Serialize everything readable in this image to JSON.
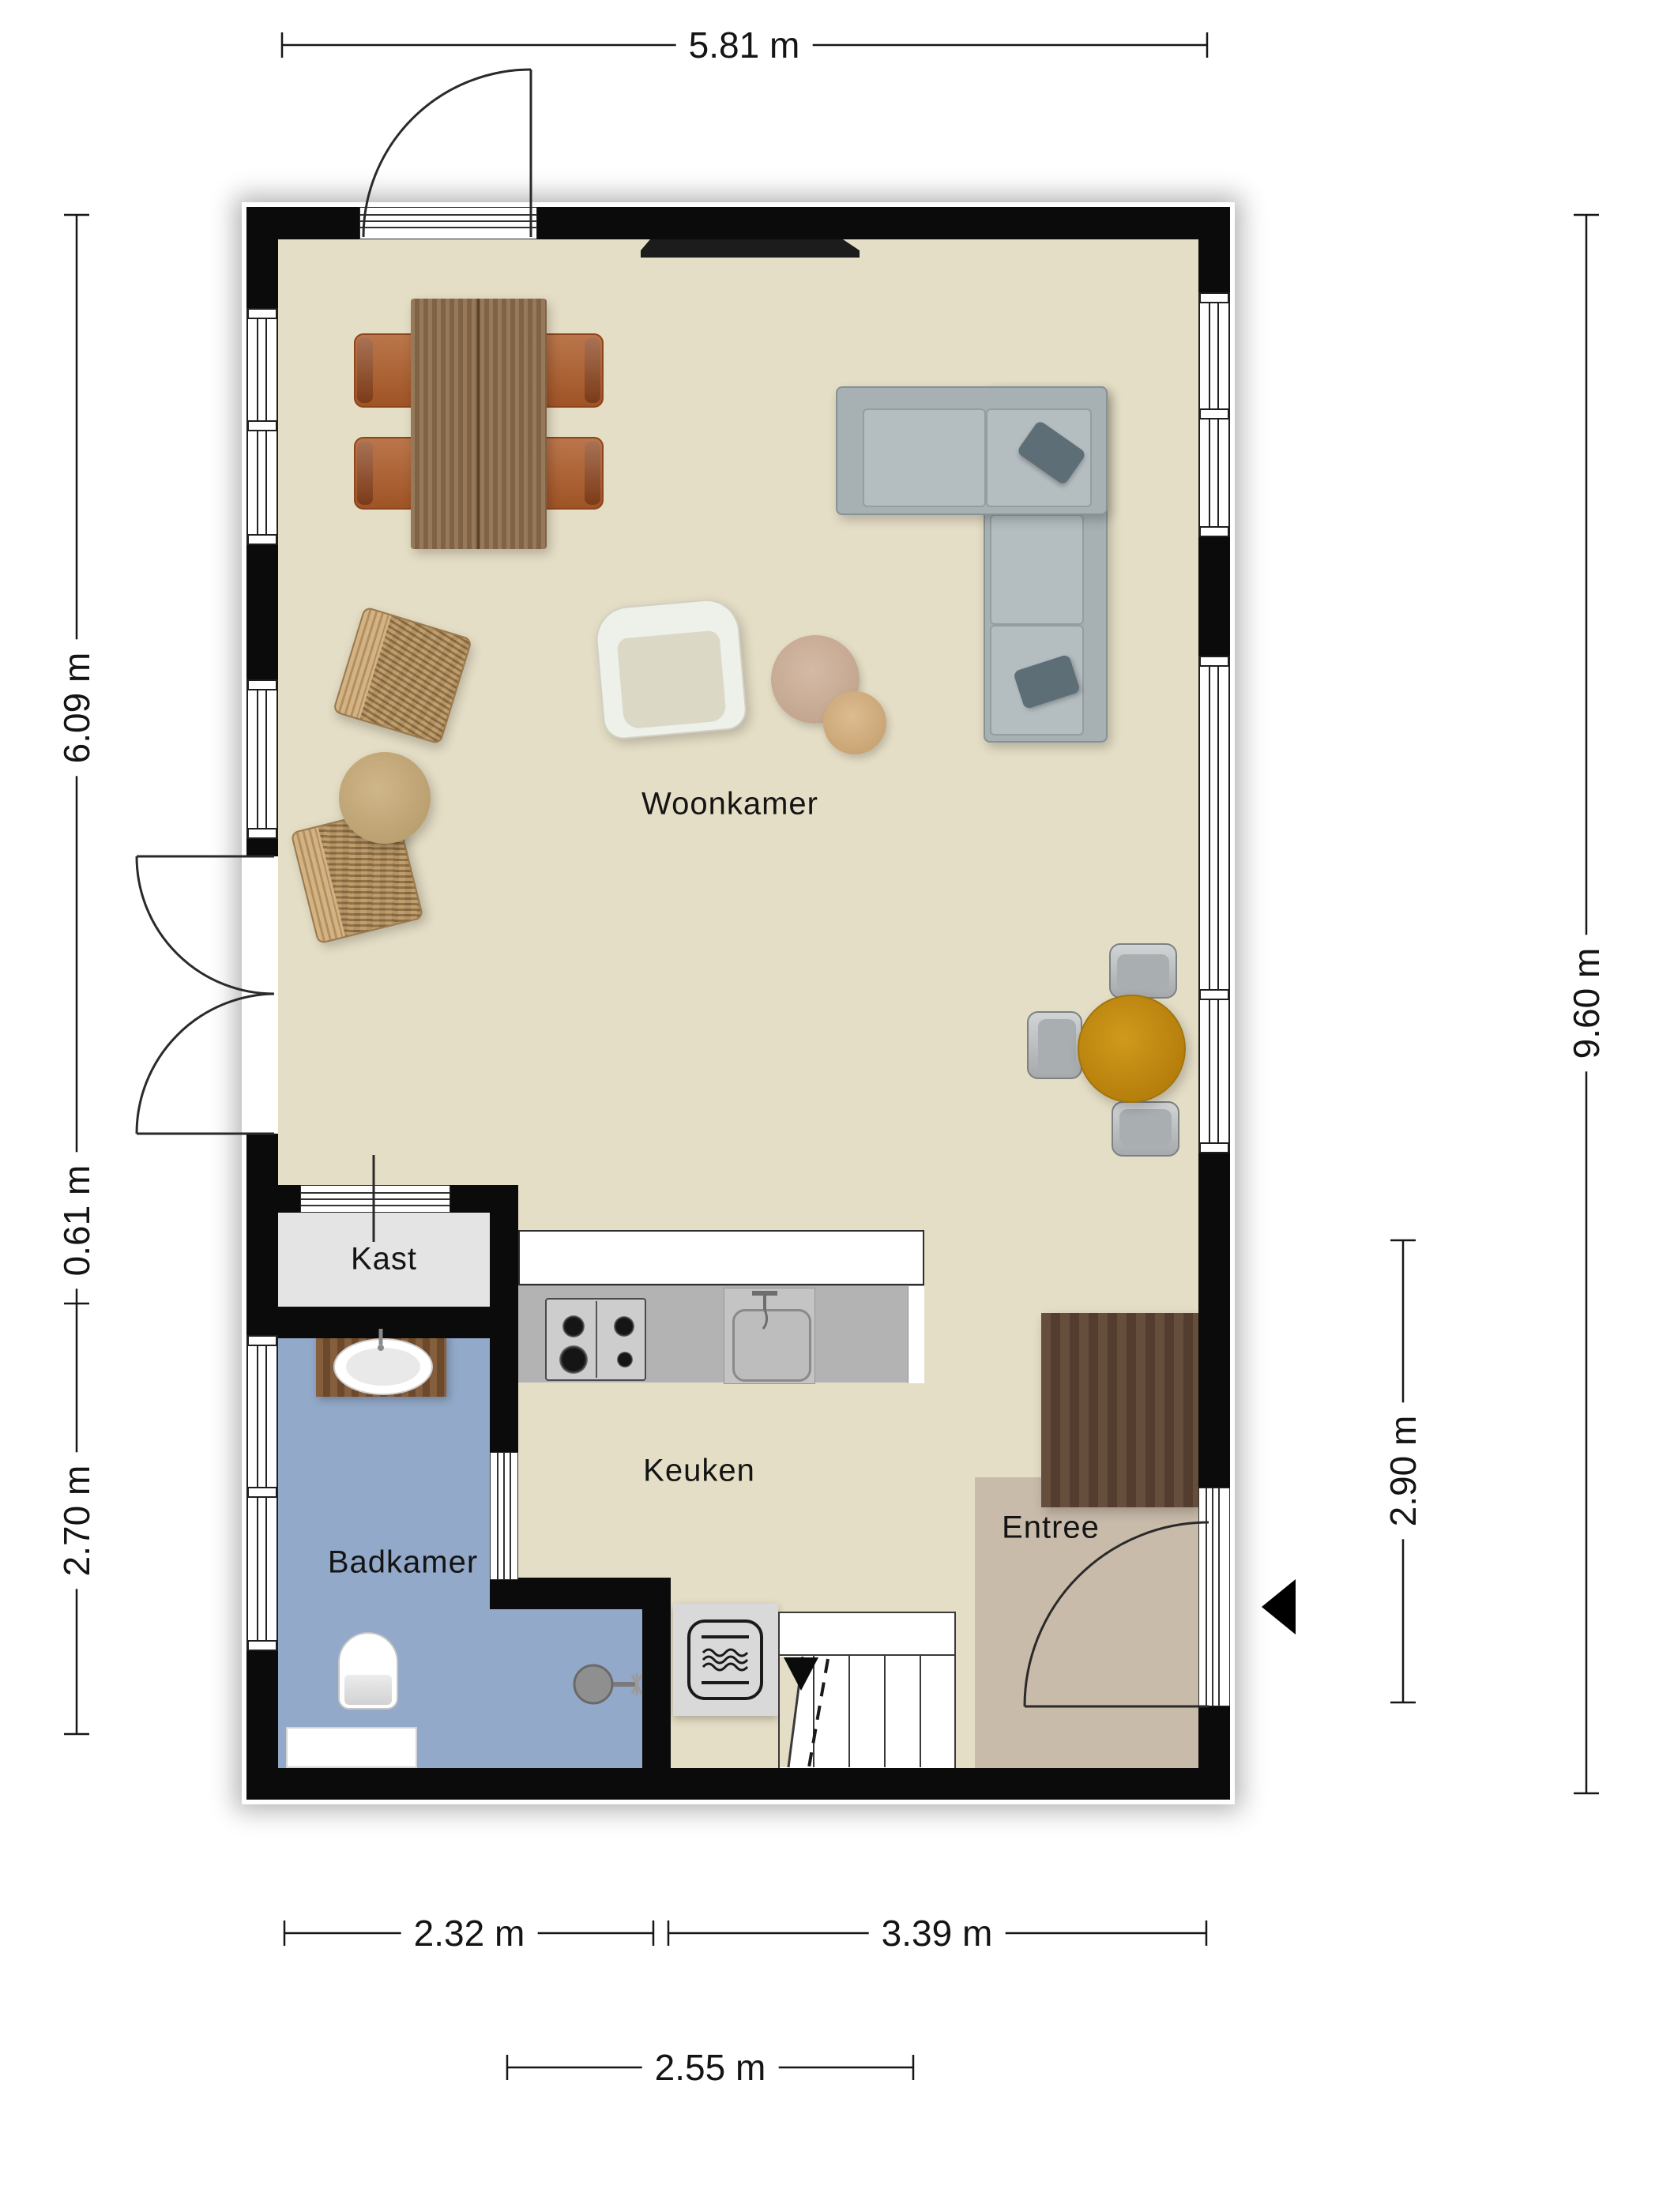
{
  "plan": {
    "rooms": {
      "woonkamer": "Woonkamer",
      "keuken": "Keuken",
      "badkamer": "Badkamer",
      "entree": "Entree",
      "kast": "Kast"
    },
    "dimensions": {
      "top_width": "5.81 m",
      "left_upper": "6.09 m",
      "left_middle": "0.61 m",
      "left_lower": "2.70 m",
      "right_total": "9.60 m",
      "right_inner": "2.90 m",
      "bottom_left": "2.32 m",
      "bottom_right": "3.39 m",
      "bottom_counter": "2.55 m"
    },
    "colors": {
      "wall": "#0b0b0b",
      "floor_main": "#e5dec6",
      "floor_entree": "#c9bbaa",
      "floor_badkamer": "#93a9c9",
      "floor_kast": "#e4e4e4",
      "counter": "#b3b3b3",
      "sofa": "#a7b0b3",
      "dining_table_wood": "#8a6a4b",
      "chair_cognac": "#ad5b28",
      "round_table_amber": "#c08a12",
      "desk_wood": "#5c4433",
      "vanity_wood": "#7b5331",
      "wicker_tan": "#b3905f"
    },
    "furniture": [
      "tv-cabinet",
      "dining-table",
      "dining-chairs",
      "wicker-chair",
      "pouf",
      "armchair",
      "side-tables",
      "corner-sofa",
      "throw-pillows",
      "round-table",
      "gray-chairs",
      "desk",
      "kitchen-counter",
      "stove",
      "kitchen-sink",
      "vanity-sink",
      "toilet",
      "shower",
      "microwave-oven",
      "staircase",
      "entrance-door",
      "french-doors",
      "garden-door"
    ]
  }
}
